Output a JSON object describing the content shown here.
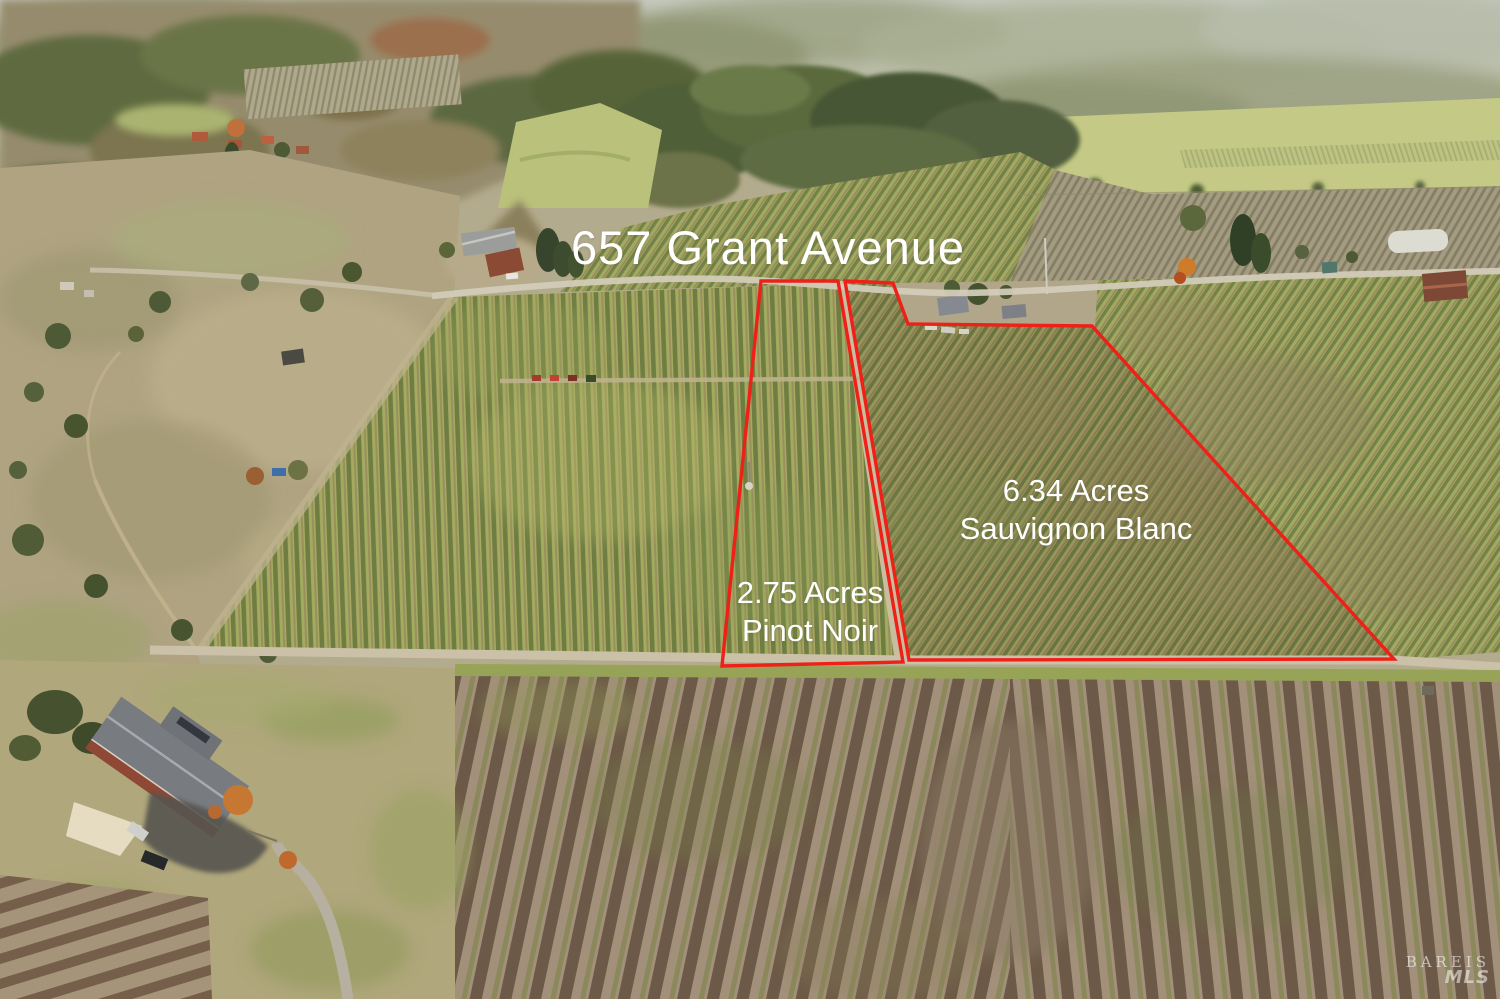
{
  "title": "657 Grant Avenue",
  "parcels": [
    {
      "id": "pinot-noir",
      "acreage": "2.75 Acres",
      "variety": "Pinot Noir"
    },
    {
      "id": "sauvignon-blanc",
      "acreage": "6.34 Acres",
      "variety": "Sauvignon Blanc"
    }
  ],
  "watermark": {
    "org": "BAREIS",
    "suffix": "MLS"
  },
  "colors": {
    "boundary": "#ee2018",
    "label": "#ffffff"
  }
}
